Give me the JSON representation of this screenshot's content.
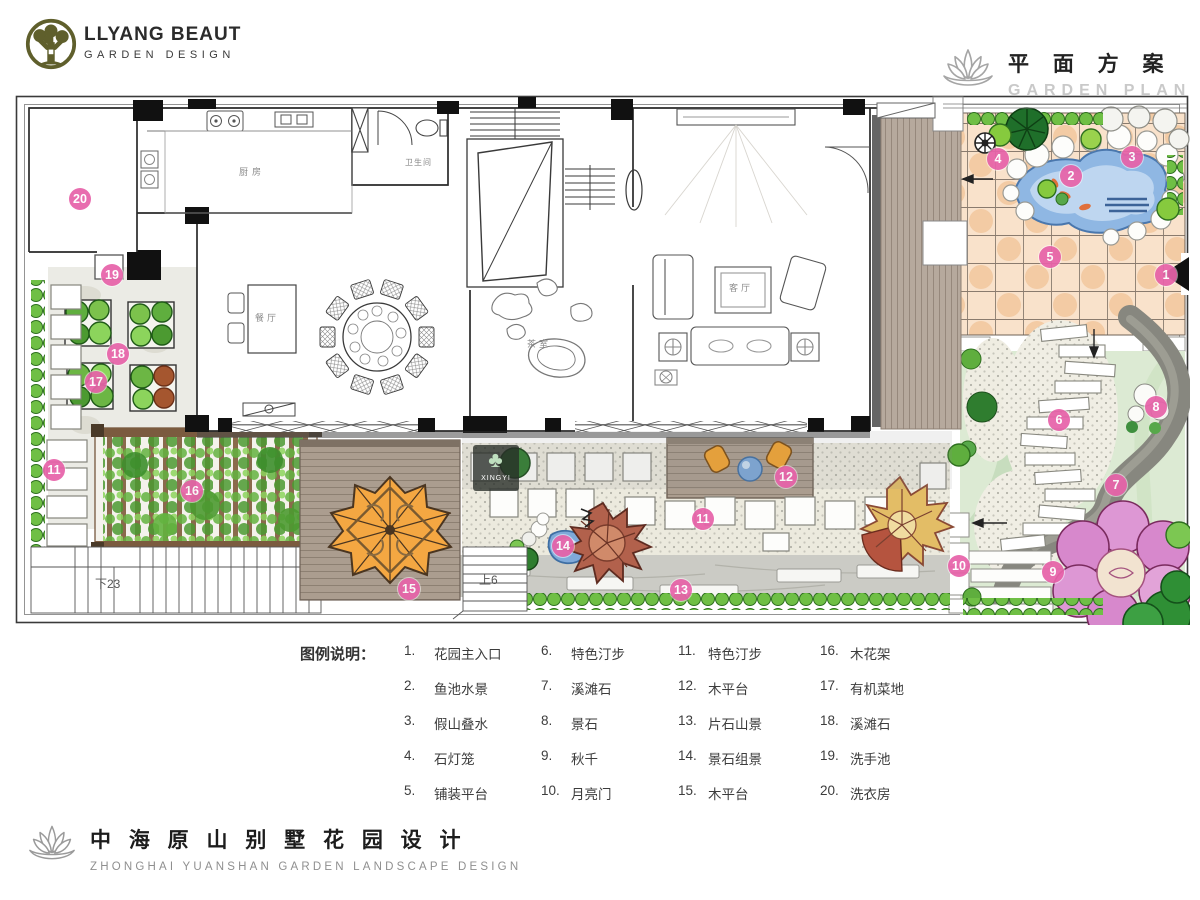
{
  "header": {
    "brand_line1": "LLYANG BEAUT",
    "brand_line2": "GARDEN DESIGN",
    "plan_title_cn": "平 面 方 案",
    "plan_title_en": "GARDEN PLAN"
  },
  "legend": {
    "heading": "图例说明：",
    "columns": [
      {
        "items": [
          {
            "num": "1.",
            "label": "花园主入口"
          },
          {
            "num": "2.",
            "label": "鱼池水景"
          },
          {
            "num": "3.",
            "label": "假山叠水"
          },
          {
            "num": "4.",
            "label": "石灯笼"
          },
          {
            "num": "5.",
            "label": "铺装平台"
          }
        ]
      },
      {
        "items": [
          {
            "num": "6.",
            "label": "特色汀步"
          },
          {
            "num": "7.",
            "label": "溪滩石"
          },
          {
            "num": "8.",
            "label": "景石"
          },
          {
            "num": "9.",
            "label": "秋千"
          },
          {
            "num": "10.",
            "label": "月亮门"
          }
        ]
      },
      {
        "items": [
          {
            "num": "11.",
            "label": "特色汀步"
          },
          {
            "num": "12.",
            "label": "木平台"
          },
          {
            "num": "13.",
            "label": "片石山景"
          },
          {
            "num": "14.",
            "label": "景石组景"
          },
          {
            "num": "15.",
            "label": "木平台"
          }
        ]
      },
      {
        "items": [
          {
            "num": "16.",
            "label": "木花架"
          },
          {
            "num": "17.",
            "label": "有机菜地"
          },
          {
            "num": "18.",
            "label": "溪滩石"
          },
          {
            "num": "19.",
            "label": "洗手池"
          },
          {
            "num": "20.",
            "label": "洗衣房"
          }
        ]
      }
    ]
  },
  "footer": {
    "title_cn": "中 海 原 山 别 墅 花 园 设 计",
    "title_en": "ZHONGHAI YUANSHAN GARDEN LANDSCAPE DESIGN"
  },
  "plan": {
    "watermark": "XINGYI",
    "colors": {
      "marker_pink": "#e763a9",
      "terrace_peach": "#f9e2cb",
      "pond_blue": "#8fb7e3",
      "lawn_green": "#dcead3",
      "deck_wood": "#b6a99d",
      "parasol_orange": "#f4a742"
    },
    "markers": [
      {
        "n": "1",
        "x": 1151,
        "y": 180
      },
      {
        "n": "2",
        "x": 1056,
        "y": 81
      },
      {
        "n": "3",
        "x": 1117,
        "y": 62
      },
      {
        "n": "4",
        "x": 983,
        "y": 64
      },
      {
        "n": "5",
        "x": 1035,
        "y": 162
      },
      {
        "n": "6",
        "x": 1044,
        "y": 325
      },
      {
        "n": "7",
        "x": 1101,
        "y": 390
      },
      {
        "n": "8",
        "x": 1141,
        "y": 312
      },
      {
        "n": "9",
        "x": 1038,
        "y": 477
      },
      {
        "n": "10",
        "x": 944,
        "y": 471
      },
      {
        "n": "11",
        "x": 688,
        "y": 424
      },
      {
        "n": "11",
        "x": 39,
        "y": 375
      },
      {
        "n": "12",
        "x": 771,
        "y": 382
      },
      {
        "n": "13",
        "x": 666,
        "y": 495
      },
      {
        "n": "14",
        "x": 548,
        "y": 451
      },
      {
        "n": "15",
        "x": 394,
        "y": 494
      },
      {
        "n": "16",
        "x": 177,
        "y": 396
      },
      {
        "n": "17",
        "x": 81,
        "y": 287
      },
      {
        "n": "18",
        "x": 103,
        "y": 259
      },
      {
        "n": "19",
        "x": 97,
        "y": 180
      },
      {
        "n": "20",
        "x": 65,
        "y": 104
      }
    ],
    "labels": [
      {
        "t": "厨房",
        "x": 224,
        "y": 70,
        "s": 9,
        "ls": 4,
        "c": "#8a8a8a"
      },
      {
        "t": "卫生间",
        "x": 390,
        "y": 62,
        "s": 8,
        "ls": 1,
        "c": "#8a8a8a"
      },
      {
        "t": "餐厅",
        "x": 240,
        "y": 216,
        "s": 9,
        "ls": 3,
        "c": "#8a8a8a"
      },
      {
        "t": "茶室",
        "x": 512,
        "y": 242,
        "s": 9,
        "ls": 3,
        "c": "#8a8a8a"
      },
      {
        "t": "客厅",
        "x": 714,
        "y": 186,
        "s": 9,
        "ls": 3,
        "c": "#8a8a8a"
      },
      {
        "t": "下23",
        "x": 80,
        "y": 480,
        "s": 12,
        "ls": 0,
        "c": "#555555"
      },
      {
        "t": "上6",
        "x": 464,
        "y": 476,
        "s": 12,
        "ls": 0,
        "c": "#555555"
      }
    ]
  }
}
